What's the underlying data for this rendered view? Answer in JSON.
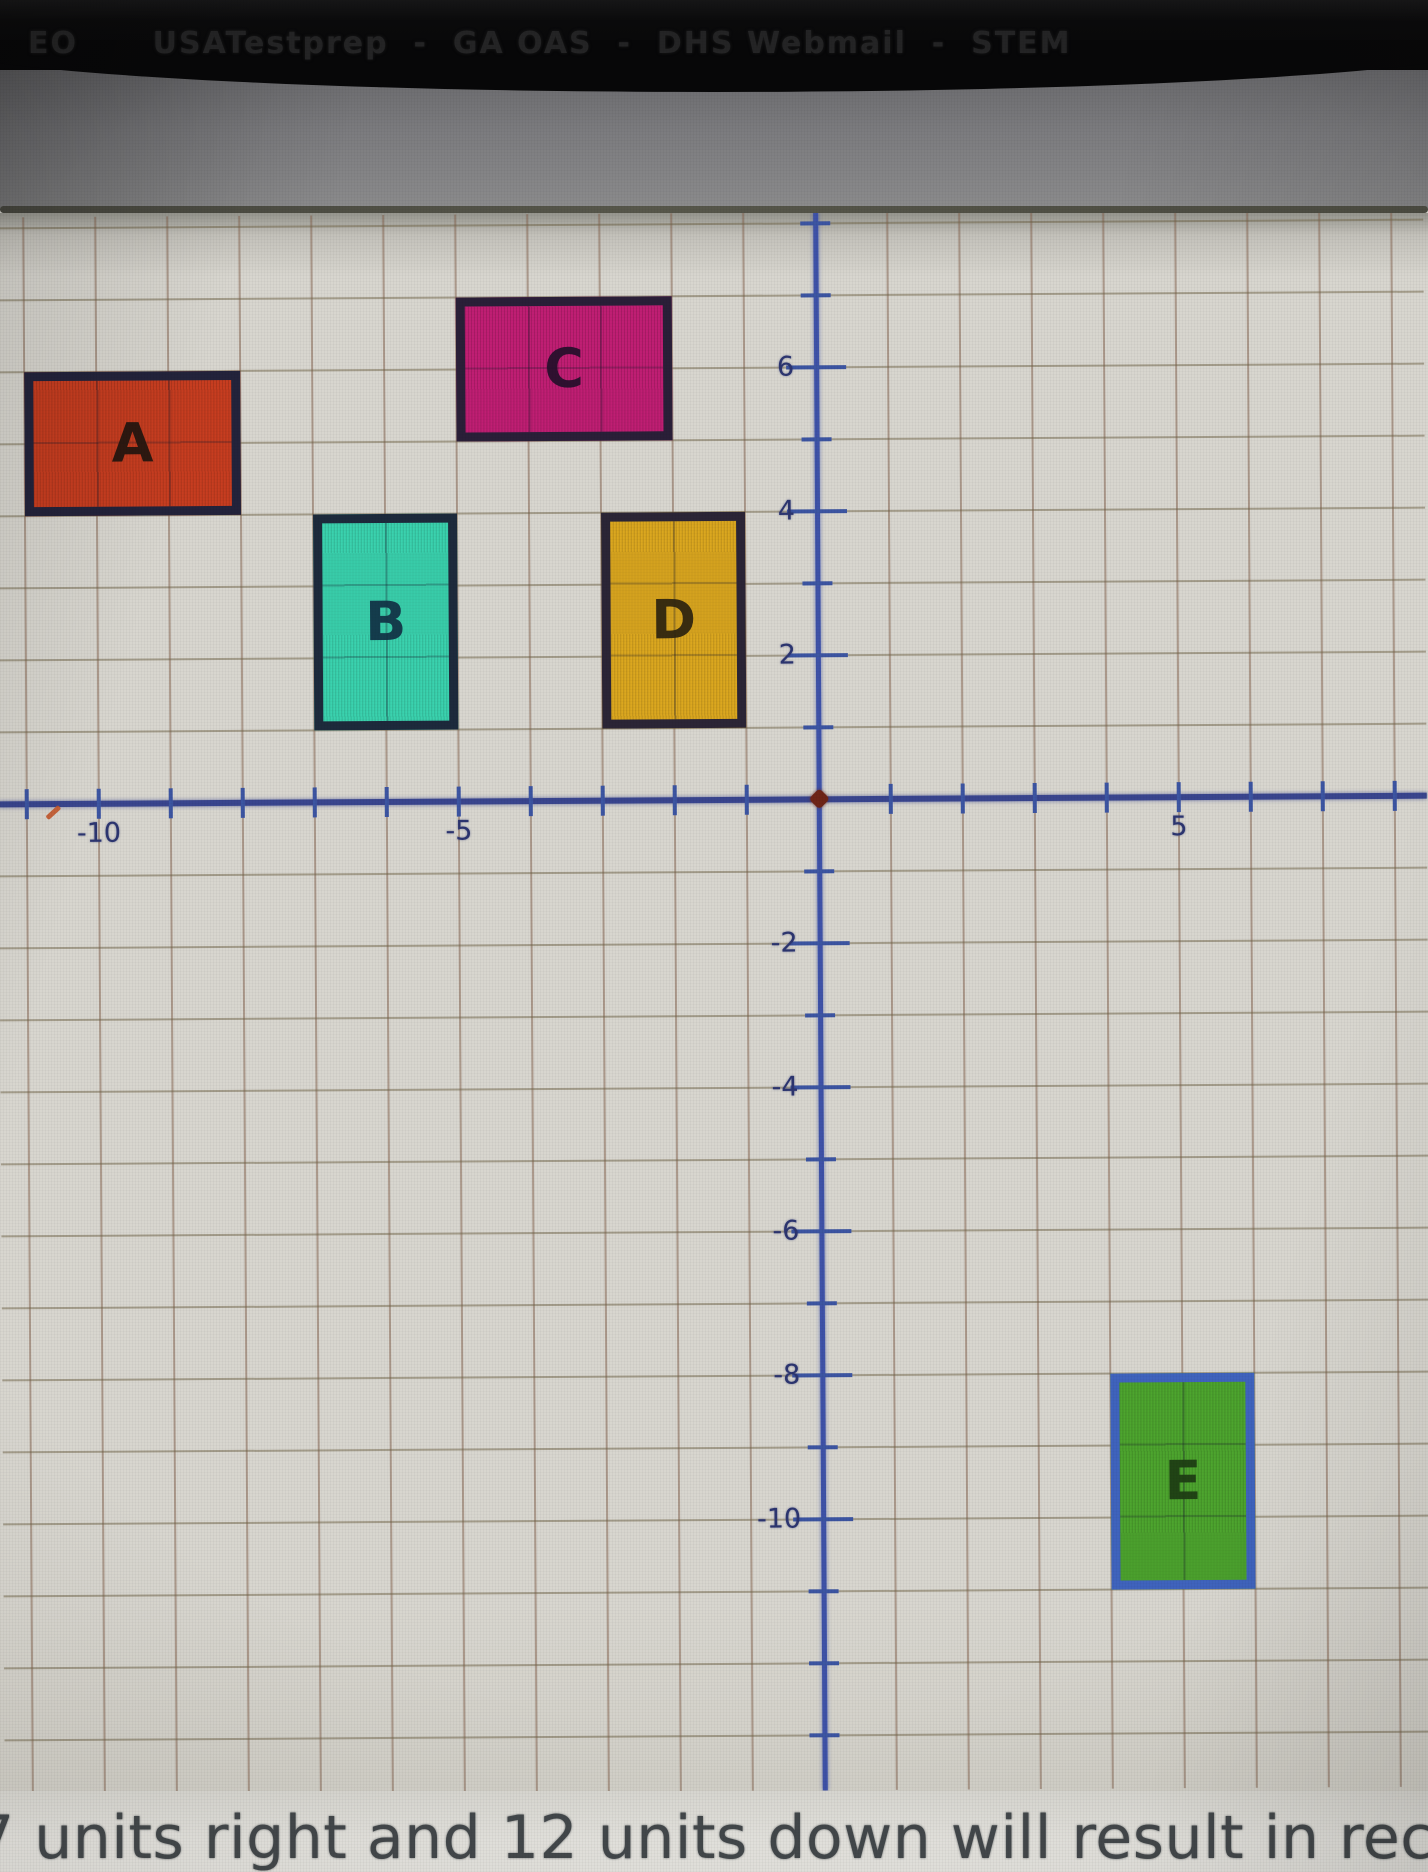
{
  "browser": {
    "bookmarks": [
      "EO",
      "USATestprep",
      "GA OAS",
      "DHS Webmail",
      "STEM"
    ],
    "bookmarks_line": "EO      USATestprep  -  GA OAS  -  DHS Webmail  -  STEM"
  },
  "graph": {
    "x_tick_labels": [
      {
        "text": "-10",
        "value": -10
      },
      {
        "text": "-5",
        "value": -5
      },
      {
        "text": "5",
        "value": 5
      }
    ],
    "y_tick_labels": [
      {
        "text": "6",
        "value": 6
      },
      {
        "text": "4",
        "value": 4
      },
      {
        "text": "2",
        "value": 2
      },
      {
        "text": "-2",
        "value": -2
      },
      {
        "text": "-4",
        "value": -4
      },
      {
        "text": "-6",
        "value": -6
      },
      {
        "text": "-8",
        "value": -8
      },
      {
        "text": "-10",
        "value": -10
      }
    ],
    "rectangles": [
      {
        "label": "A",
        "x_min": -11,
        "x_max": -8,
        "y_min": 4,
        "y_max": 6,
        "fill": "#c73d20",
        "border": "#23233b",
        "label_color": "#23160f"
      },
      {
        "label": "B",
        "x_min": -7,
        "x_max": -5,
        "y_min": 1,
        "y_max": 4,
        "fill": "#3ad2ae",
        "border": "#1d2a3c",
        "label_color": "#123246"
      },
      {
        "label": "C",
        "x_min": -5,
        "x_max": -2,
        "y_min": 5,
        "y_max": 7,
        "fill": "#bf1e73",
        "border": "#2a1f38",
        "label_color": "#26102c"
      },
      {
        "label": "D",
        "x_min": -3,
        "x_max": -1,
        "y_min": 1,
        "y_max": 4,
        "fill": "#dba71f",
        "border": "#2b2536",
        "label_color": "#2e2410"
      },
      {
        "label": "E",
        "x_min": 4,
        "x_max": 6,
        "y_min": -11,
        "y_max": -8,
        "fill": "#4da52e",
        "border": "#3f63bd",
        "label_color": "#1e3d14"
      }
    ],
    "axis_color": "#39458e",
    "gridline_color": "#7e5c48"
  },
  "question": {
    "visible_text": "7 units right and 12 units down will result in rectangle E?"
  }
}
